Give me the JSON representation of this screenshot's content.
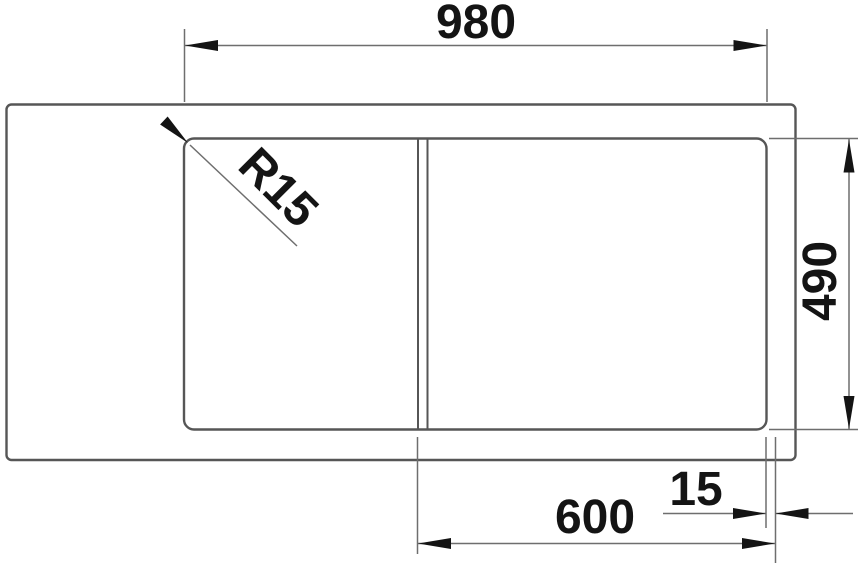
{
  "drawing": {
    "kind": "technical-dimension-drawing",
    "subject": "inset sink top view with bowl, drainer divider and dimension callouts",
    "dimensions": {
      "overall_width": "980",
      "overall_depth": "490",
      "bowl_section_width": "600",
      "edge_gap": "15",
      "corner_radius": "R15"
    },
    "colors": {
      "outline": "#565656",
      "dimension_lines": "#6e6e6e",
      "arrows_and_text": "#141414",
      "background": "#ffffff"
    }
  }
}
